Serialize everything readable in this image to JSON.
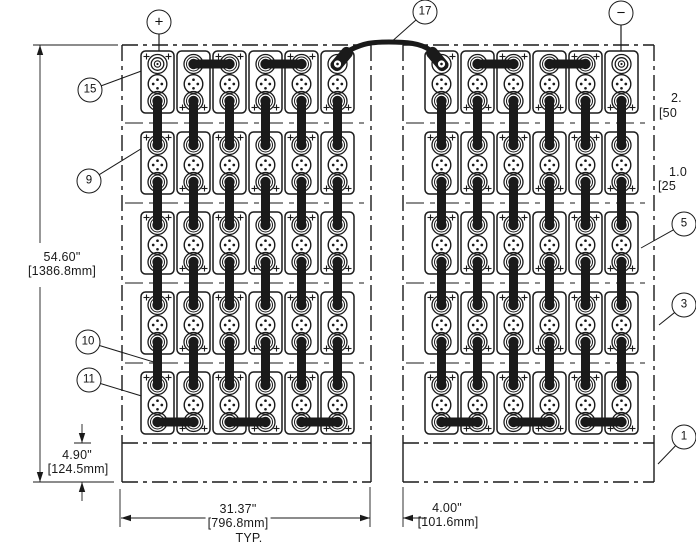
{
  "drawing": {
    "polarity_positive": "+",
    "polarity_negative": "−",
    "callouts": {
      "c17": "17",
      "c15": "15",
      "c9": "9",
      "c10": "10",
      "c11": "11",
      "c5": "5",
      "c3": "3",
      "c1": "1"
    },
    "dims": {
      "overall_height_in": "54.60\"",
      "overall_height_mm": "[1386.8mm]",
      "base_height_in": "4.90\"",
      "base_height_mm": "[124.5mm]",
      "bank_width_in": "31.37\"",
      "bank_width_mm": "[796.8mm]",
      "bank_width_note": "TYP.",
      "gap_width_in": "4.00\"",
      "gap_width_mm": "[101.6mm]",
      "right_edge_top_in": "2.",
      "right_edge_top_mm": "[50",
      "right_edge_mid_in": "1.0",
      "right_edge_mid_mm": "[25"
    },
    "structure": {
      "banks": 2,
      "rows_per_bank": 5,
      "cells_per_row": 6
    }
  }
}
